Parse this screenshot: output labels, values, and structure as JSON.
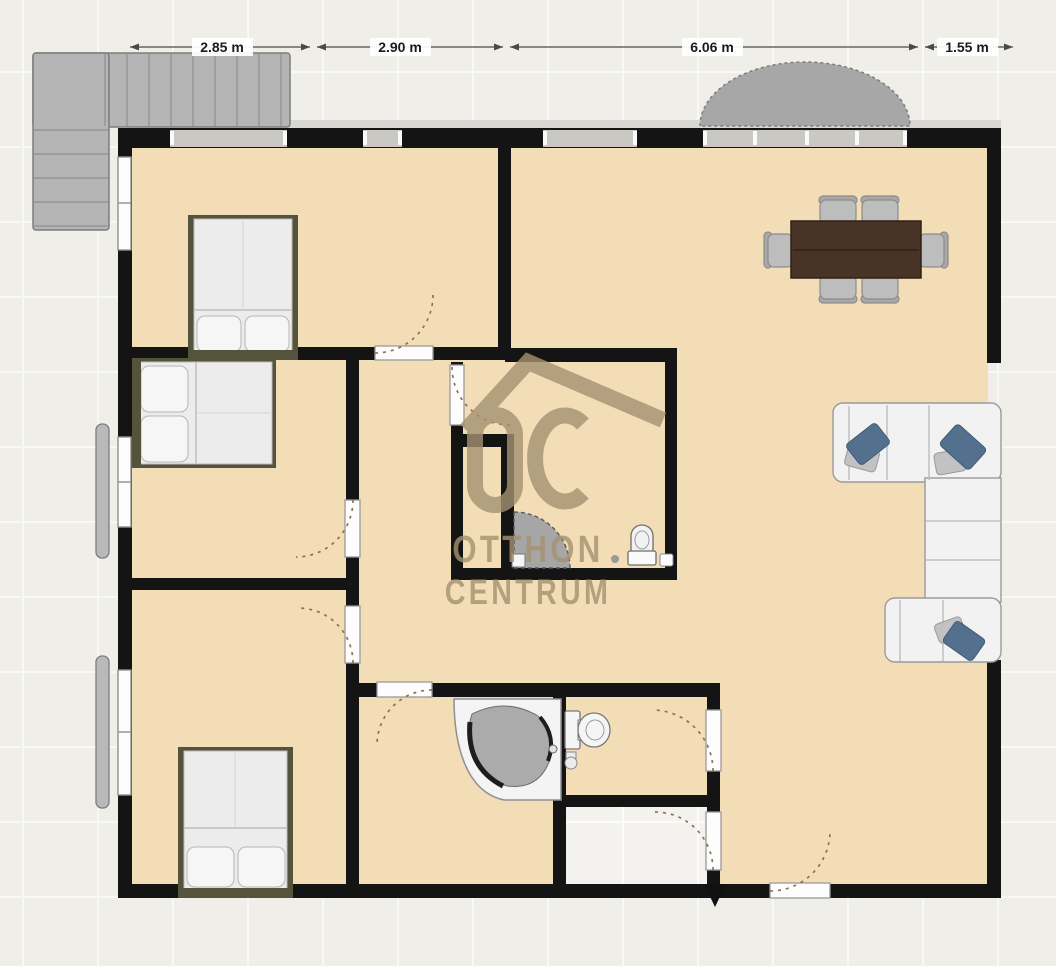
{
  "page": {
    "type": "floor-plan-view",
    "background_color": "#efeee9",
    "floor_color": "#f3ddb6",
    "wall_color": "#141414"
  },
  "dimension_labels": [
    {
      "id": "dim-1",
      "label": "2.85 m"
    },
    {
      "id": "dim-2",
      "label": "2.90 m"
    },
    {
      "id": "dim-3",
      "label": "6.06 m"
    },
    {
      "id": "dim-4",
      "label": "1.55 m"
    }
  ],
  "watermark": {
    "brand_top": "OTTHON",
    "brand_bottom": "CENTRUM",
    "logo_letters": "OC",
    "color": "#a49171"
  },
  "palette": {
    "outside_grid_line": "#ffffff",
    "stairs": "#b5b5b5",
    "canopy": "#a7a7a7",
    "door_panel": "#fdfdfd",
    "door_swing_arc": "#8a7355",
    "bed_frame": "#54533b",
    "mattress": "#ececec",
    "table_wood": "#483426",
    "chair": "#bdbdbd",
    "sofa": "#f2f2f2",
    "pillow_accent": "#53718e",
    "tub_basin": "#ababab",
    "shower_tray": "#a6a6a6"
  },
  "furniture": [
    {
      "name": "staircase",
      "location": "top-left outside"
    },
    {
      "name": "entrance-canopy",
      "location": "top center-right outside"
    },
    {
      "name": "double-bed",
      "location": "bedroom top-left"
    },
    {
      "name": "double-bed",
      "location": "bedroom middle-left"
    },
    {
      "name": "double-bed",
      "location": "bedroom bottom-left"
    },
    {
      "name": "dining-table-with-six-chairs",
      "location": "living room top-right"
    },
    {
      "name": "sectional-sofa",
      "location": "living room right wall"
    },
    {
      "name": "corner-bathtub",
      "location": "bathroom bottom-center"
    },
    {
      "name": "toilet",
      "location": "wc bottom-center"
    },
    {
      "name": "toilet",
      "location": "central shower room"
    },
    {
      "name": "corner-shower",
      "location": "central shower room"
    },
    {
      "name": "window-shutter",
      "location": "left facade"
    }
  ]
}
